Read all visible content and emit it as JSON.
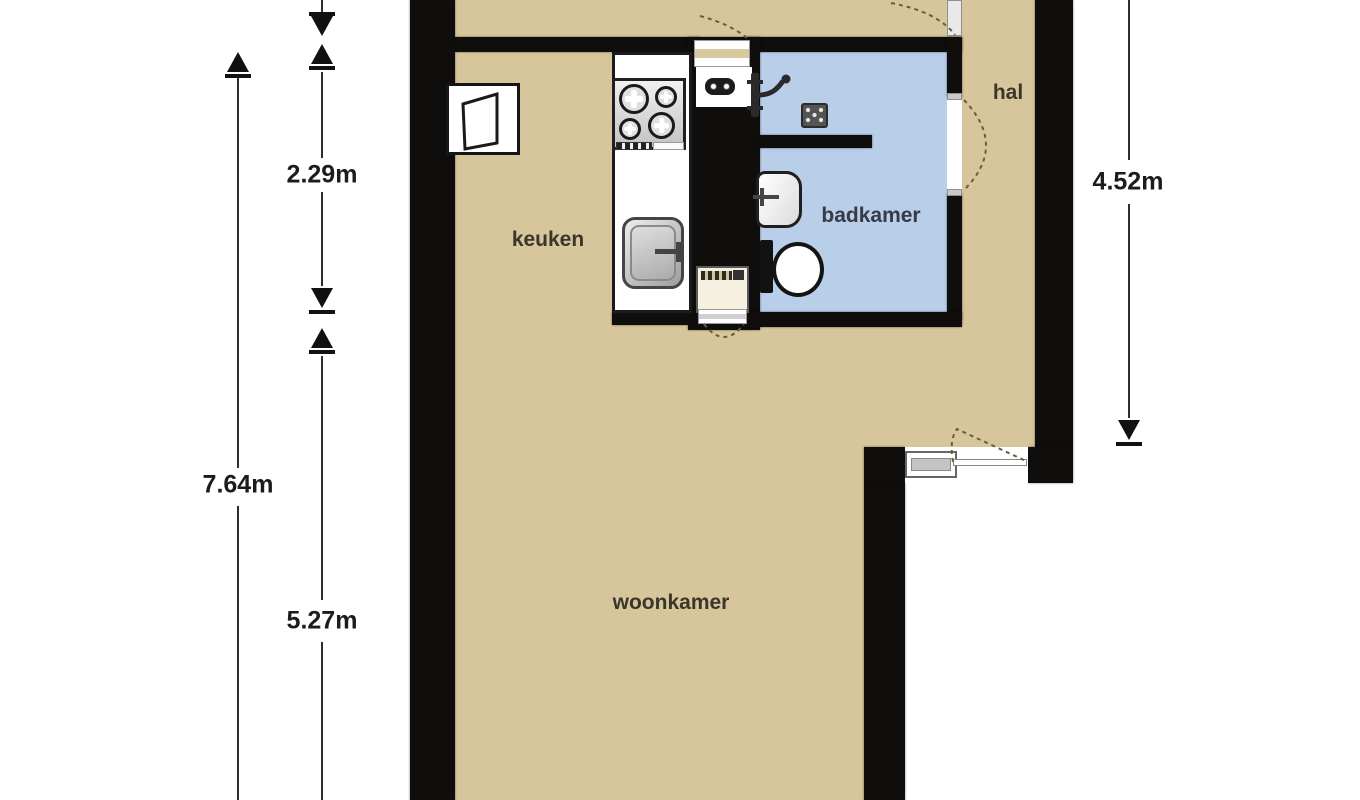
{
  "plan": {
    "rooms": {
      "kitchen": {
        "label": "keuken"
      },
      "bathroom": {
        "label": "badkamer"
      },
      "hall": {
        "label": "hal"
      },
      "living_room": {
        "label": "woonkamer"
      }
    },
    "dimensions": {
      "left_total": {
        "label": "7.64m"
      },
      "kitchen_height": {
        "label": "2.29m"
      },
      "living_height": {
        "label": "5.27m"
      },
      "hall_height": {
        "label": "4.52m"
      }
    },
    "colors": {
      "canvas": "#ffffff",
      "wall": "#0f0e0c",
      "floor": "#d7c69c",
      "bathroom_floor": "#b9cee9",
      "label_text": "#3b362a",
      "bathroom_label_text": "#363b45",
      "dimension_text": "#1c1c1c",
      "door_arc": "#6a5c40"
    },
    "fixtures": {
      "stove": "stove-4-burner-icon",
      "kitchen_sink": "kitchen-sink-icon",
      "wall_cabinet": "wall-cabinet-icon",
      "boiler_outlet": "boiler-outlet-icon",
      "washing_machine": "washing-machine-icon",
      "shower_mixer": "shower-mixer-icon",
      "shower_drain": "shower-drain-icon",
      "washbasin": "washbasin-icon",
      "toilet": "toilet-icon",
      "window": "window-icon",
      "doors": "door-swing-arc"
    }
  }
}
